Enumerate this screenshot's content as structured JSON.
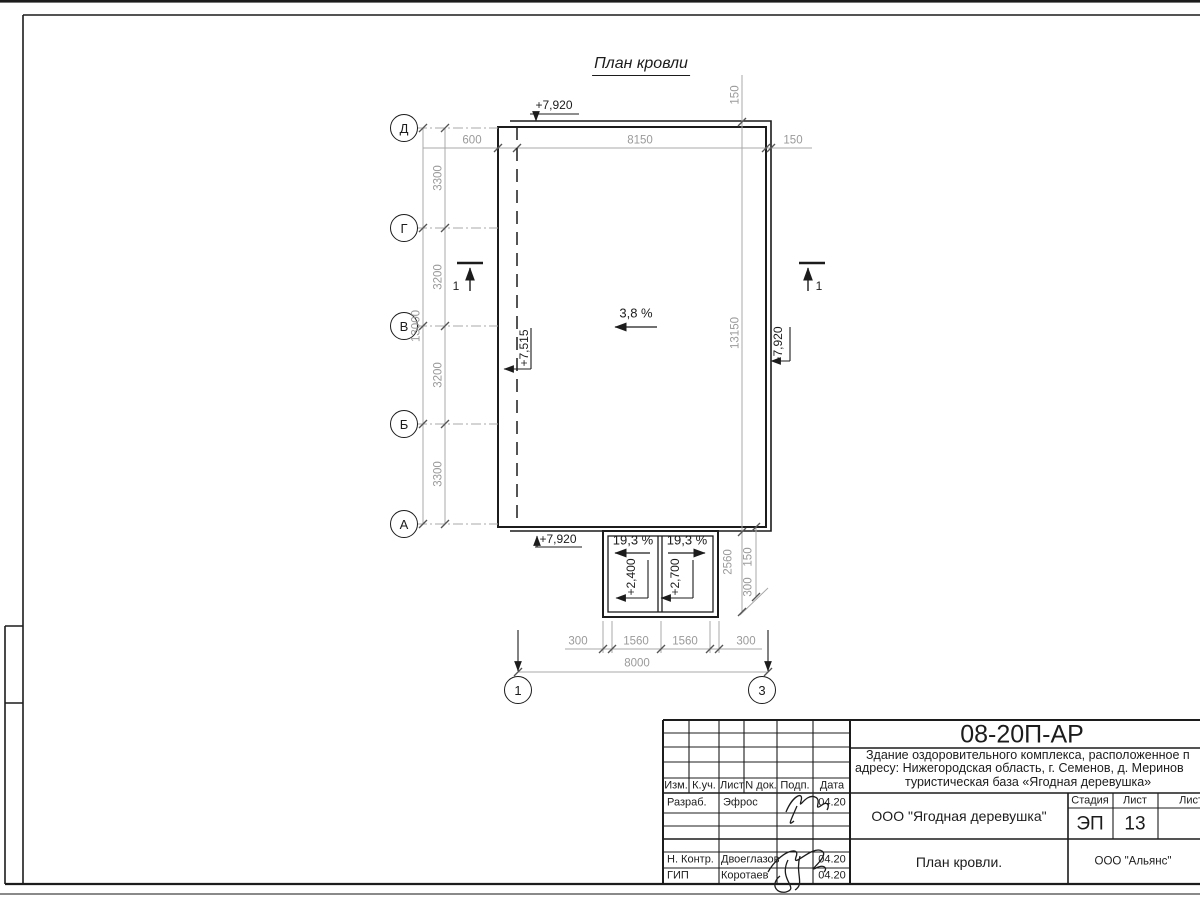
{
  "drawing_title": "План кровли",
  "axes": {
    "left_labels": [
      "Д",
      "Г",
      "В",
      "Б",
      "А"
    ],
    "bottom_labels": [
      "1",
      "3"
    ]
  },
  "dims": {
    "top": [
      "600",
      "8150",
      "150"
    ],
    "left": [
      "3300",
      "3200",
      "3200",
      "3300"
    ],
    "left_total": "13000",
    "right_top": "150",
    "right_total": "13150",
    "right_canopy": [
      "2560",
      "150",
      "300"
    ],
    "bottom": [
      "300",
      "1560",
      "1560",
      "300"
    ],
    "bottom_total": "8000"
  },
  "elevations": {
    "roof_top": "+7,920",
    "roof_bottom": "+7,920",
    "roof_left": "+7,515",
    "roof_right": "+7,920",
    "canopy_left": "+2,400",
    "canopy_right": "+2,700"
  },
  "slopes": {
    "main": "3,8 %",
    "canopy_left": "19,3 %",
    "canopy_right": "19,3 %"
  },
  "section": {
    "left": "1",
    "right": "1"
  },
  "title_block": {
    "code": "08-20П-АР",
    "project": [
      "Здание оздоровительного комплекса, расположенное п",
      "адресу: Нижегородская область, г. Семенов, д. Меринов",
      "туристическая база «Ягодная деревушка»"
    ],
    "cols": [
      "Изм.",
      "К.уч.",
      "Лист",
      "N док.",
      "Подп.",
      "Дата"
    ],
    "rows": [
      {
        "label": "Разраб.",
        "name": "Эфрос",
        "date": "04.20"
      },
      {
        "label": "Н. Контр.",
        "name": "Двоеглазов",
        "date": "04.20"
      },
      {
        "label": "ГИП",
        "name": "Коротаев",
        "date": "04.20"
      }
    ],
    "org": "ООО \"Ягодная деревушка\"",
    "stage_label": "Стадия",
    "sheet_label": "Лист",
    "sheets_label": "Листов",
    "stage": "ЭП",
    "sheet_no": "13",
    "sheet_title": "План кровли.",
    "company": "ООО \"Альянс\""
  },
  "colors": {
    "line_dark": "#1c1c1c",
    "line_gray": "#a8a8a8",
    "text_gray": "#9a9a9a"
  }
}
